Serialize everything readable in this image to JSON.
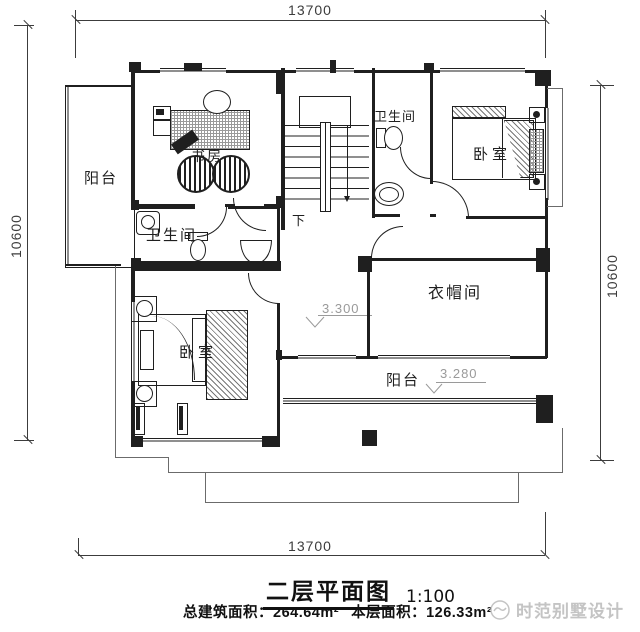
{
  "dimensions": {
    "top": "13700",
    "bottom": "13700",
    "left": "10600",
    "right": "10600"
  },
  "rooms": {
    "balcony_left": "阳台",
    "study": "书房",
    "stairs_down": "下",
    "bath_top": "卫生间",
    "bedroom_top": "卧室",
    "bath_mid": "卫生间",
    "closet": "衣帽间",
    "bedroom_bottom": "卧室",
    "balcony_bottom": "阳台"
  },
  "elevations": {
    "hall": "3.300",
    "balcony": "3.280"
  },
  "title": {
    "name": "二层平面图",
    "scale": "1:100"
  },
  "areas": {
    "total": "总建筑面积：264.64m²",
    "floor": "本层面积：126.33m²"
  },
  "watermark": {
    "text": "时范别墅设计"
  },
  "colors": {
    "line": "#1f1f1f",
    "dim": "#3c3c3c",
    "thin": "#6b6b6b",
    "elev": "#9a9a9a",
    "watermark": "#c4c4c4",
    "bg": "#ffffff"
  }
}
